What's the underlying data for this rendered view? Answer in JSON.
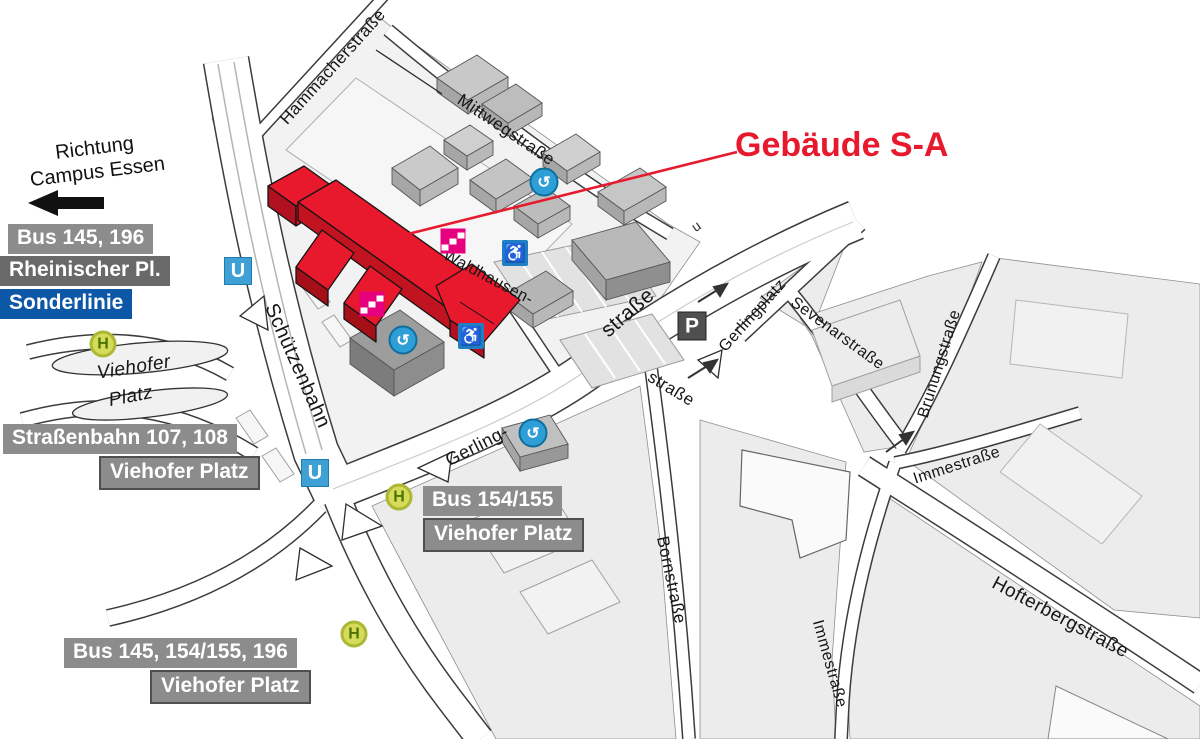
{
  "map": {
    "title": "Gebäude S-A",
    "direction": {
      "line1": "Richtung",
      "line2": "Campus Essen"
    },
    "badges": {
      "bus_145_196": "Bus 145, 196",
      "rheinischer_pl": "Rheinischer Pl.",
      "sonderlinie": "Sonderlinie",
      "strassenbahn_107_108": "Straßenbahn 107, 108",
      "viehofer_platz_tram": "Viehofer Platz",
      "bus_154_155": "Bus 154/155",
      "viehofer_platz_bus": "Viehofer Platz",
      "bus_145_154_155_196": "Bus 145, 154/155, 196",
      "viehofer_platz_bus_south": "Viehofer Platz"
    },
    "streets": {
      "hammacherstrasse": "Hammacherstraße",
      "mittwegstrasse": "Mittwegstraße",
      "schuetzenbahn": "Schützenbahn",
      "waldhausen": "Waldhausen-",
      "waldhausen_suffix": "straße",
      "gerling": "Gerling-",
      "gerling_suffix": "straße",
      "gerlingplatz": "Gerlingplatz",
      "sevenarstrasse": "Sevenarstraße",
      "brunungstrasse": "Brunungstraße",
      "immestrasse_upper": "Immestraße",
      "immestrasse_lower": "Immestraße",
      "bornstrasse": "Bornstraße",
      "hofterbergstrasse": "Hofterbergstraße",
      "viehofer": "Viehofer",
      "platz": "Platz"
    },
    "icons": {
      "tram_stop_letter": "H",
      "subway_letter": "U",
      "parking_letter": "P",
      "circular_glyph": "↺",
      "wheelchair_glyph": "♿",
      "underpass_mark": "u"
    },
    "colors": {
      "accent_red": "#e8192c",
      "sonderlinie_blue": "#0d57a7",
      "badge_gray": "#8c8c8c",
      "badge_dark_gray": "#696969",
      "subway_blue": "#3fa0d6",
      "tram_stop_yellow": "#d7db5a",
      "wheelchair_blue": "#1f7fc4",
      "stairs_magenta": "#e6007e",
      "parking_dark": "#4f4f4f"
    }
  }
}
